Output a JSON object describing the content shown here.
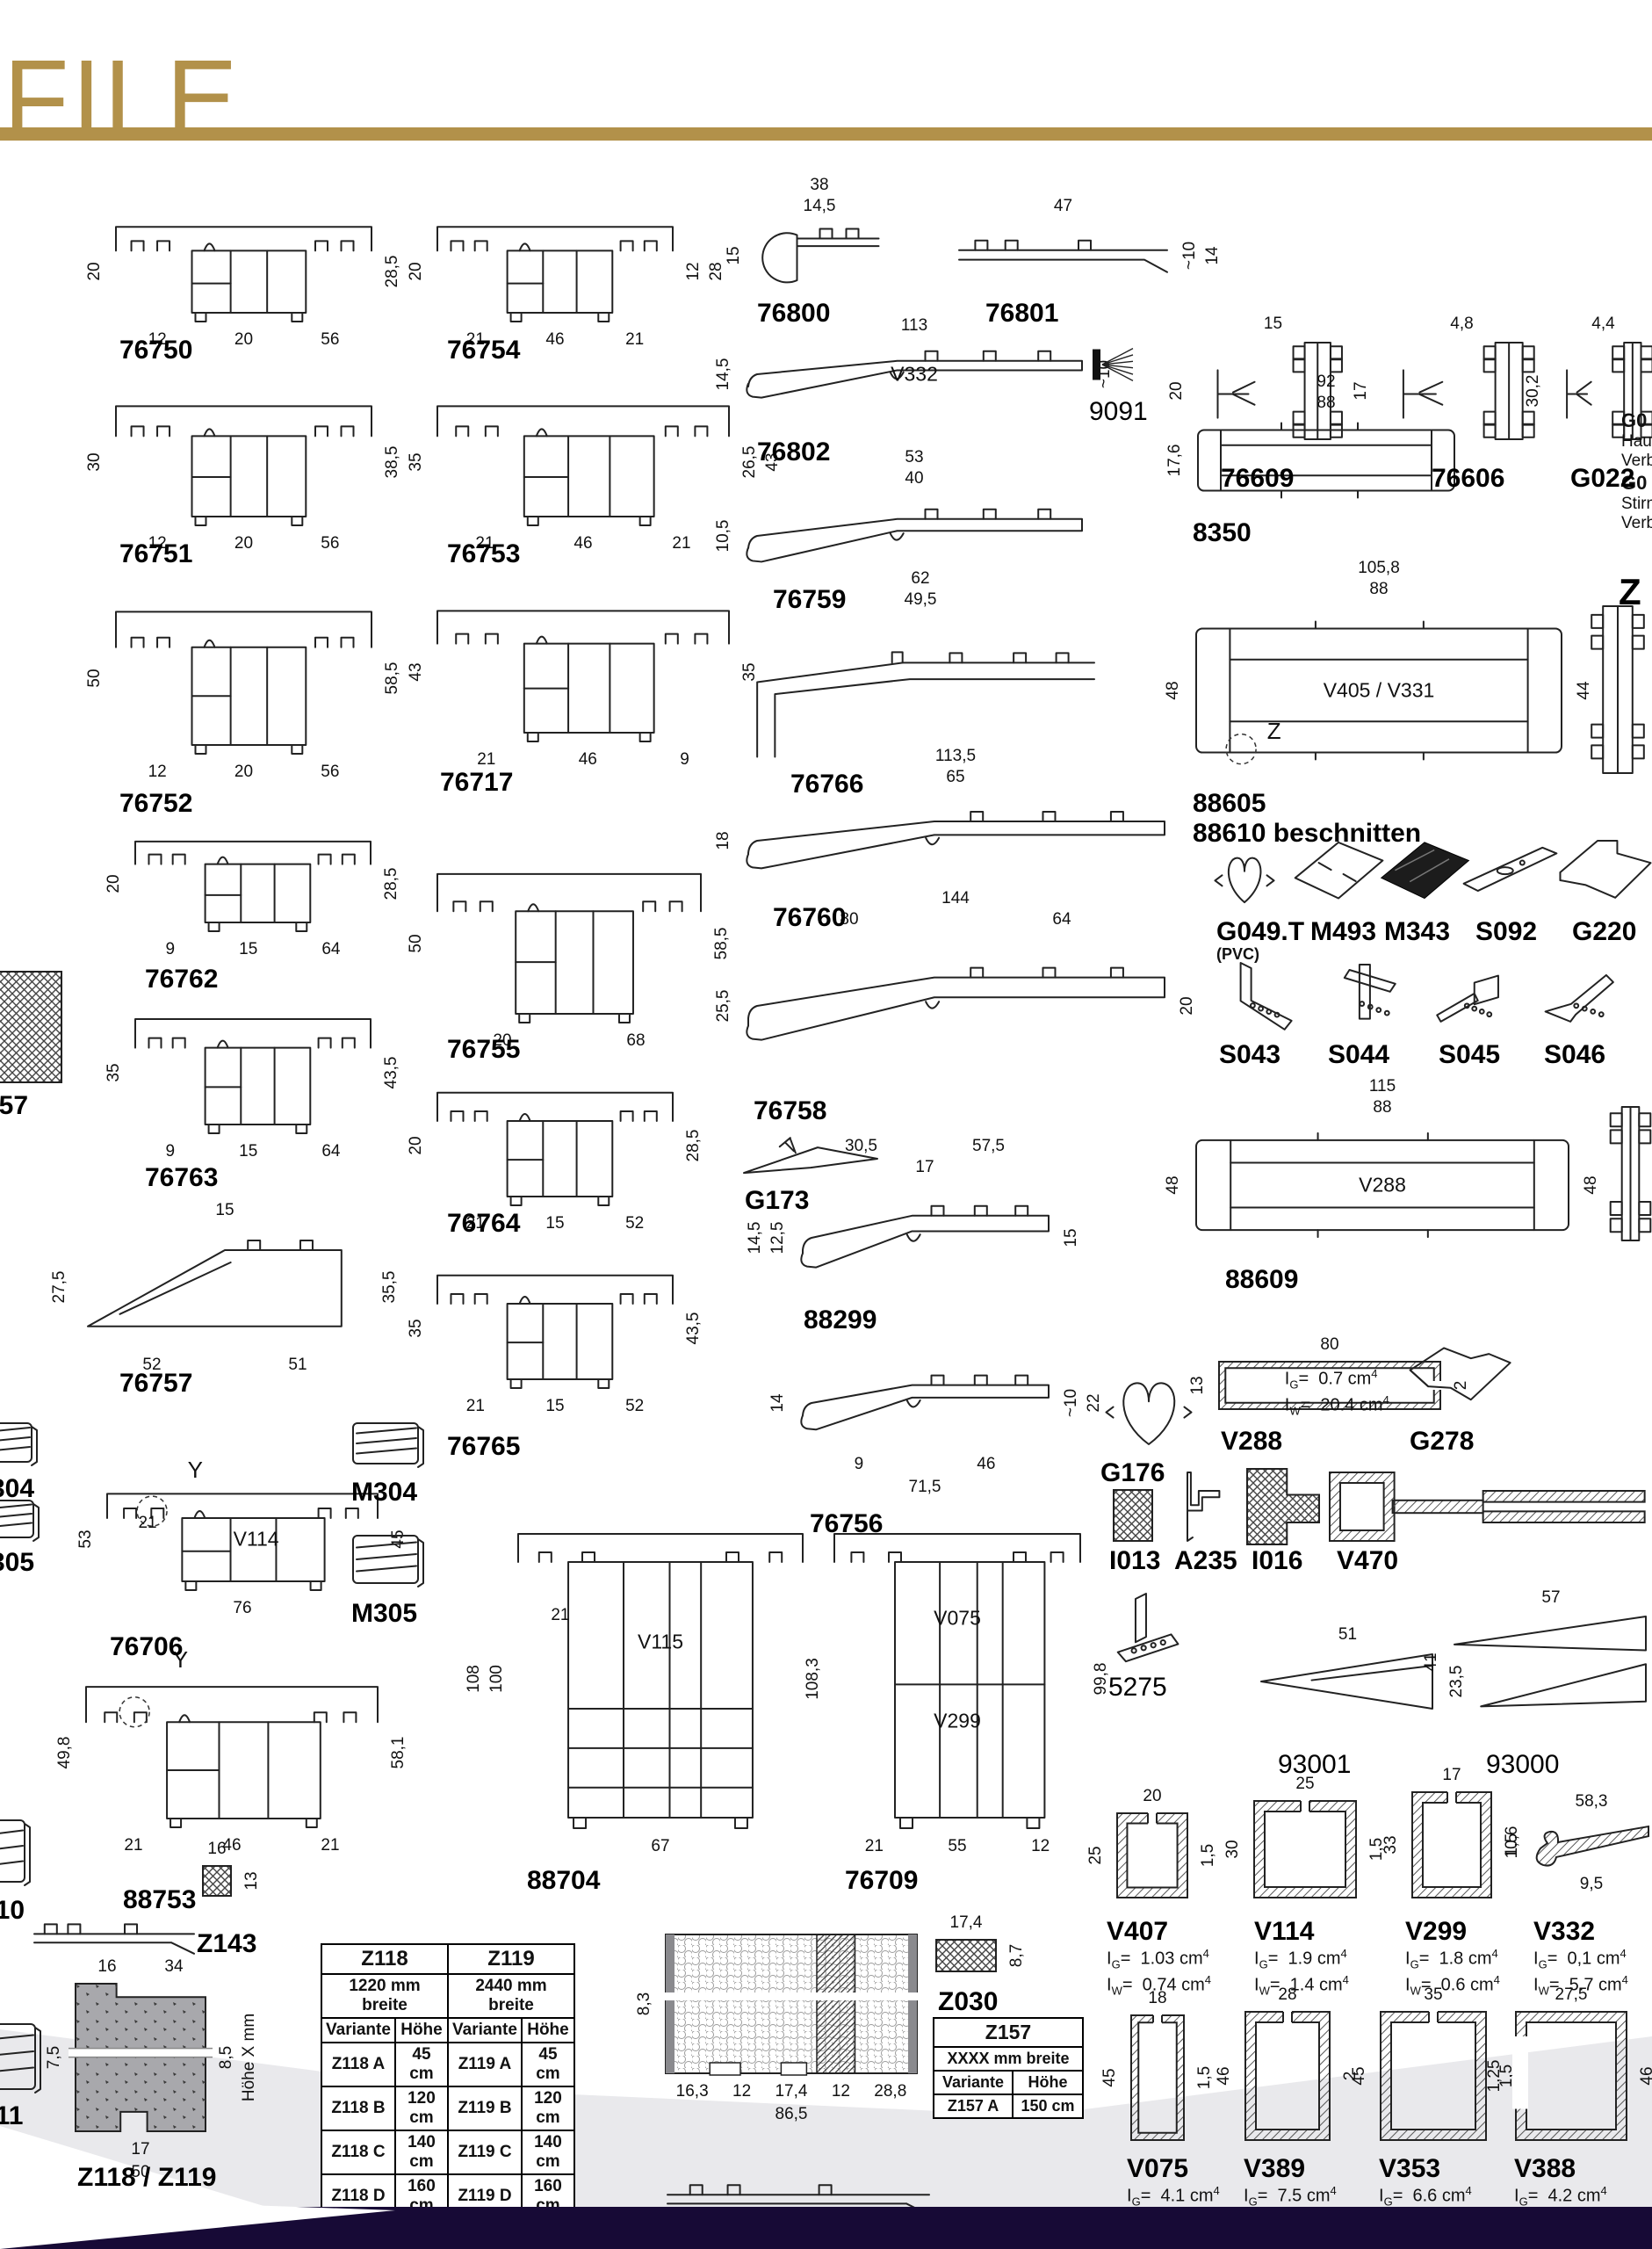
{
  "page": {
    "title": "FILE",
    "accent": "#b2914a",
    "footer_color": "#170a36",
    "band_color": "#e9e9ec",
    "paper": "#ffffff"
  },
  "edge_text": {
    "lines": [
      {
        "t": "G0",
        "b": 1
      },
      {
        "t": "Hau",
        "b": 0
      },
      {
        "t": "Verb",
        "b": 0
      },
      {
        "t": "G0",
        "b": 1
      },
      {
        "t": "Stirn",
        "b": 0
      },
      {
        "t": "Verb",
        "b": 0
      }
    ]
  },
  "tables": {
    "z118": {
      "headers": [
        "Z118",
        "Z119"
      ],
      "subheaders": [
        "1220 mm breite",
        "2440 mm breite"
      ],
      "columns": [
        "Variante",
        "Höhe",
        "Variante",
        "Höhe"
      ],
      "rows": [
        [
          "Z118 A",
          "45 cm",
          "Z119 A",
          "45 cm"
        ],
        [
          "Z118 B",
          "120 cm",
          "Z119 B",
          "120 cm"
        ],
        [
          "Z118 C",
          "140 cm",
          "Z119 C",
          "140 cm"
        ],
        [
          "Z118 D",
          "160 cm",
          "Z119 D",
          "160 cm"
        ]
      ]
    },
    "z157": {
      "header": "Z157",
      "subheader": "XXXX mm breite",
      "columns": [
        "Variante",
        "Höhe"
      ],
      "rows": [
        [
          "Z157 A",
          "150 cm"
        ]
      ]
    }
  },
  "items": [
    {
      "id": "t76750",
      "label": "76750",
      "type": "rail",
      "l": [
        "20"
      ],
      "r": [
        "28,5"
      ],
      "b": [
        [
          "12",
          "20",
          "56"
        ]
      ]
    },
    {
      "id": "t76754",
      "label": "76754",
      "type": "rail",
      "l": [
        "20"
      ],
      "r": [
        "28",
        "12"
      ],
      "b": [
        [
          "21",
          "46",
          "21"
        ]
      ]
    },
    {
      "id": "t76751",
      "label": "76751",
      "type": "rail",
      "l": [
        "30"
      ],
      "r": [
        "38,5"
      ],
      "b": [
        [
          "12",
          "20",
          "56"
        ]
      ]
    },
    {
      "id": "t76753",
      "label": "76753",
      "type": "rail",
      "l": [
        "35"
      ],
      "r": [
        "43",
        "26,5"
      ],
      "b": [
        [
          "21",
          "46",
          "21"
        ]
      ]
    },
    {
      "id": "t76752",
      "label": "76752",
      "type": "rail",
      "l": [
        "50"
      ],
      "r": [
        "58,5"
      ],
      "b": [
        [
          "12",
          "20",
          "56"
        ]
      ]
    },
    {
      "id": "t76717",
      "label": "76717",
      "type": "rail",
      "l": [
        "43"
      ],
      "r": [
        "35"
      ],
      "b": [
        [
          "21",
          "46",
          "9"
        ]
      ]
    },
    {
      "id": "t76762",
      "label": "76762",
      "type": "rail",
      "l": [
        "20"
      ],
      "r": [
        "28,5"
      ],
      "b": [
        [
          "9",
          "15",
          "64"
        ]
      ]
    },
    {
      "id": "t76755",
      "label": "76755",
      "type": "rail",
      "l": [
        "50"
      ],
      "r": [
        "58,5"
      ],
      "b": [
        [
          "20",
          "68"
        ]
      ]
    },
    {
      "id": "t76763",
      "label": "76763",
      "type": "rail",
      "l": [
        "35"
      ],
      "r": [
        "43,5"
      ],
      "b": [
        [
          "9",
          "15",
          "64"
        ]
      ]
    },
    {
      "id": "t76764",
      "label": "76764",
      "type": "rail",
      "l": [
        "20"
      ],
      "r": [
        "28,5"
      ],
      "b": [
        [
          "21",
          "15",
          "52"
        ]
      ]
    },
    {
      "id": "t76757",
      "label": "76757",
      "type": "sillwedge",
      "t": [
        [
          "15"
        ]
      ],
      "l": [
        "27,5"
      ],
      "r": [
        "35,5"
      ],
      "b": [
        [
          "52",
          "51"
        ]
      ]
    },
    {
      "id": "t76765",
      "label": "76765",
      "type": "rail",
      "l": [
        "35"
      ],
      "r": [
        "43,5"
      ],
      "b": [
        [
          "21",
          "15",
          "52"
        ]
      ]
    },
    {
      "id": "t76706",
      "label": "76706",
      "type": "railwin",
      "tin": [
        "21"
      ],
      "l": [
        "53"
      ],
      "r": [
        "45"
      ],
      "b": [
        [
          "76"
        ]
      ],
      "inner": [
        "V114"
      ],
      "ann": [
        "Y"
      ]
    },
    {
      "id": "m304L",
      "label": "M304",
      "type": "cap"
    },
    {
      "id": "m305L",
      "label": "M305",
      "type": "cap"
    },
    {
      "id": "m304R",
      "label": "M304",
      "type": "cap"
    },
    {
      "id": "m305R",
      "label": "M305",
      "type": "cap"
    },
    {
      "id": "t88753",
      "label": "88753",
      "type": "railwin",
      "l": [
        "49,8"
      ],
      "r": [
        "58,1"
      ],
      "b": [
        [
          "21",
          "46",
          "21"
        ]
      ],
      "ann": [
        "Y"
      ]
    },
    {
      "id": "t310",
      "label": "310",
      "type": "cap"
    },
    {
      "id": "rail88753b",
      "type": "sillflat"
    },
    {
      "id": "t311",
      "label": "311",
      "type": "cap"
    },
    {
      "id": "t057",
      "label": "057",
      "type": "sqh"
    },
    {
      "id": "concrete",
      "label": "Z118 / Z119",
      "type": "concrete",
      "t": [
        [
          "16",
          "34"
        ]
      ],
      "l": [
        "7,5"
      ],
      "r": [
        "Höhe X mm",
        "8,5"
      ],
      "b": [
        [
          "17"
        ],
        [
          "50"
        ]
      ]
    },
    {
      "id": "z143",
      "label": "Z143",
      "type": "sqh",
      "t": [
        [
          "16"
        ]
      ],
      "r": [
        "13"
      ]
    },
    {
      "id": "t88704",
      "label": "88704",
      "type": "tall",
      "tin": [
        "21"
      ],
      "l": [
        "108",
        "100"
      ],
      "b": [
        [
          "67"
        ]
      ],
      "inner": [
        "V115"
      ]
    },
    {
      "id": "t76709",
      "label": "76709",
      "type": "tall2",
      "l": [
        "108,3"
      ],
      "r": [
        "99,8"
      ],
      "b": [
        [
          "21",
          "55",
          "12"
        ]
      ],
      "inner": [
        "V075",
        "V299"
      ]
    },
    {
      "id": "panel",
      "type": "panel",
      "l": [
        "8,3"
      ],
      "b": [
        [
          "16,3",
          "12",
          "17,4",
          "12",
          "28,8"
        ],
        [
          "86,5"
        ]
      ]
    },
    {
      "id": "panelb",
      "type": "sillflat"
    },
    {
      "id": "z030",
      "label": "Z030",
      "type": "sqh",
      "t": [
        [
          "17,4"
        ]
      ],
      "r": [
        "8,7"
      ]
    },
    {
      "id": "t76800",
      "label": "76800",
      "type": "sillcap",
      "t": [
        [
          "38"
        ],
        [
          "14,5"
        ]
      ],
      "l": [
        "15"
      ]
    },
    {
      "id": "t76801",
      "label": "76801",
      "type": "sillflat",
      "t": [
        [
          "47"
        ]
      ],
      "r": [
        "14",
        "~10"
      ]
    },
    {
      "id": "t76802",
      "label": "76802",
      "type": "sill",
      "t": [
        [
          "113"
        ]
      ],
      "l": [
        "14,5"
      ],
      "r": [
        "~10"
      ],
      "inner": [
        "V332"
      ]
    },
    {
      "id": "i9091",
      "label": "9091",
      "reg": 1,
      "type": "brush"
    },
    {
      "id": "t76759",
      "label": "76759",
      "type": "sill",
      "t": [
        [
          "53"
        ],
        [
          "40"
        ]
      ],
      "l": [
        "10,5"
      ]
    },
    {
      "id": "t76766",
      "label": "76766",
      "type": "sillstep",
      "t": [
        [
          "62"
        ],
        [
          "49,5"
        ]
      ]
    },
    {
      "id": "t76760",
      "label": "76760",
      "type": "sill",
      "t": [
        [
          "113,5"
        ],
        [
          "65"
        ]
      ],
      "l": [
        "18"
      ]
    },
    {
      "id": "t76758",
      "label": "76758",
      "type": "sill",
      "t": [
        [
          "144"
        ],
        [
          "80",
          "64"
        ]
      ],
      "l": [
        "25,5"
      ],
      "r": [
        "20"
      ]
    },
    {
      "id": "g173",
      "label": "G173",
      "type": "g173"
    },
    {
      "id": "t88299",
      "label": "88299",
      "type": "sill",
      "t": [
        [
          "30,5",
          "57,5"
        ],
        [
          "17"
        ]
      ],
      "l": [
        "14,5",
        "12,5"
      ],
      "r": [
        "15"
      ]
    },
    {
      "id": "t76756",
      "label": "76756",
      "type": "sill",
      "l": [
        "14"
      ],
      "r": [
        "22",
        "~10"
      ],
      "b": [
        [
          "9",
          "46"
        ],
        [
          "71,5"
        ]
      ]
    },
    {
      "id": "t76609",
      "label": "76609",
      "type": "gctx",
      "t": [
        [
          "15"
        ]
      ],
      "l": [
        "20"
      ]
    },
    {
      "id": "t76606",
      "label": "76606",
      "type": "gctx",
      "t": [
        [
          "4,8"
        ]
      ],
      "l": [
        "17"
      ]
    },
    {
      "id": "g022",
      "label": "G022",
      "type": "gctx",
      "t": [
        [
          "4,4"
        ]
      ],
      "l": [
        "30,2"
      ]
    },
    {
      "id": "t8350",
      "label": "8350",
      "type": "wide",
      "t": [
        [
          "92"
        ],
        [
          "88"
        ]
      ],
      "l": [
        "17,6"
      ]
    },
    {
      "id": "t88605",
      "label": "88605",
      "label2": "88610 beschnitten",
      "type": "wide",
      "t": [
        [
          "105,8"
        ],
        [
          "88"
        ]
      ],
      "l": [
        "48"
      ],
      "r": [
        "44"
      ],
      "inner": [
        "V405 / V331"
      ],
      "ann": [
        "Z"
      ]
    },
    {
      "id": "vrail1",
      "type": "vrail"
    },
    {
      "id": "bigZ",
      "label": "Z",
      "type": "none"
    },
    {
      "id": "g049",
      "label": "G049.T",
      "sub": "(PVC)",
      "type": "gasket"
    },
    {
      "id": "m493",
      "label": "M493",
      "type": "iso"
    },
    {
      "id": "m343",
      "label": "M343",
      "type": "isodark"
    },
    {
      "id": "s092",
      "label": "S092",
      "type": "isostrip"
    },
    {
      "id": "g220",
      "label": "G220",
      "type": "isobig"
    },
    {
      "id": "s043",
      "label": "S043",
      "type": "angle"
    },
    {
      "id": "s044",
      "label": "S044",
      "type": "angle2"
    },
    {
      "id": "s045",
      "label": "S045",
      "type": "angle3"
    },
    {
      "id": "s046",
      "label": "S046",
      "type": "angle4"
    },
    {
      "id": "t88609",
      "label": "88609",
      "type": "wide",
      "t": [
        [
          "115"
        ],
        [
          "88"
        ]
      ],
      "l": [
        "48"
      ],
      "r": [
        "48"
      ],
      "inner": [
        "V288"
      ]
    },
    {
      "id": "vrail2",
      "type": "vrail"
    },
    {
      "id": "v288",
      "label": "V288",
      "type": "chanh",
      "t": [
        [
          "80"
        ]
      ],
      "l": [
        "13"
      ],
      "r": [
        "2"
      ],
      "ig": "0.7",
      "iw": "20.4",
      "vin": 1
    },
    {
      "id": "g278",
      "label": "G278",
      "type": "corner"
    },
    {
      "id": "g176",
      "label": "G176",
      "type": "gasket"
    },
    {
      "id": "i013",
      "label": "I013",
      "type": "sqh"
    },
    {
      "id": "a235",
      "label": "A235",
      "type": "zprof"
    },
    {
      "id": "i016",
      "label": "I016",
      "type": "sqh2"
    },
    {
      "id": "v470",
      "label": "V470",
      "type": "v470"
    },
    {
      "id": "i5275",
      "label": "5275",
      "reg": 1,
      "type": "post"
    },
    {
      "id": "t93001",
      "label": "93001",
      "reg": 1,
      "type": "wedge",
      "t": [
        [
          "51"
        ]
      ],
      "r": [
        "23,5"
      ]
    },
    {
      "id": "t93000",
      "label": "93000",
      "reg": 1,
      "type": "wedge2",
      "t": [
        [
          "57"
        ]
      ],
      "l": [
        "41"
      ]
    },
    {
      "id": "v407",
      "label": "V407",
      "type": "chan",
      "t": [
        [
          "20"
        ]
      ],
      "l": [
        "25"
      ],
      "r": [
        "1,5"
      ],
      "ig": "1.03",
      "iw": "0.74"
    },
    {
      "id": "v114b",
      "label": "V114",
      "type": "chan",
      "t": [
        [
          "25"
        ]
      ],
      "l": [
        "30"
      ],
      "r": [
        "1,5"
      ],
      "ig": "1.9",
      "iw": "1.4"
    },
    {
      "id": "v299b",
      "label": "V299",
      "type": "chan",
      "t": [
        [
          "17"
        ]
      ],
      "l": [
        "33"
      ],
      "r": [
        "1,5"
      ],
      "ig": "1.8",
      "iw": "0.6"
    },
    {
      "id": "v332b",
      "label": "V332",
      "type": "hook",
      "t": [
        [
          "58,3"
        ]
      ],
      "l": [
        "10,6"
      ],
      "r": [
        "2"
      ],
      "b": [
        [
          "9,5"
        ]
      ],
      "ig": "0,1",
      "iw": "5.7"
    },
    {
      "id": "v075",
      "label": "V075",
      "type": "chan",
      "t": [
        [
          "18"
        ]
      ],
      "l": [
        "45"
      ],
      "r": [
        "1,5"
      ],
      "ig": "4.1",
      "iw": "1.0"
    },
    {
      "id": "v389",
      "label": "V389",
      "type": "chan",
      "t": [
        [
          "28"
        ]
      ],
      "l": [
        "46"
      ],
      "r": [
        "2"
      ],
      "ig": "7.5",
      "iw": "3.4"
    },
    {
      "id": "v353",
      "label": "V353",
      "type": "chan",
      "t": [
        [
          "35"
        ]
      ],
      "l": [
        "45"
      ],
      "r": [
        "1,5"
      ],
      "ig": "6.6",
      "iw": "4.5"
    },
    {
      "id": "v388",
      "label": "V388",
      "type": "chanl",
      "t": [
        [
          "27,5"
        ]
      ],
      "l": [
        "1,25"
      ],
      "r": [
        "40",
        "46"
      ],
      "ig": "4.2",
      "iw": "0.94"
    }
  ]
}
